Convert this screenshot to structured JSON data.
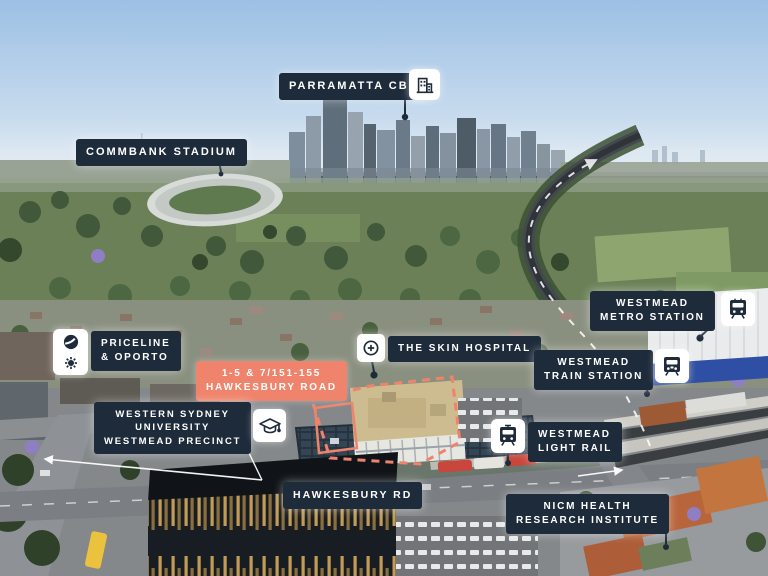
{
  "title": "Westmead aerial locality map",
  "colors": {
    "label_background": "#1e2b3b",
    "label_text": "#ffffff",
    "site_accent_coral": "#f0836b",
    "icon_tile_background": "#ffffff",
    "icon_glyph": "#1e2b3b"
  },
  "labels": {
    "parramatta_cbd": {
      "text": "PARRAMATTA CBD",
      "icon": "city-buildings-icon"
    },
    "commbank_stadium": {
      "text": "COMMBANK STADIUM"
    },
    "westmead_metro_station": {
      "lines": [
        "WESTMEAD",
        "METRO STATION"
      ],
      "icon": "metro-train-icon"
    },
    "priceline_oporto": {
      "lines": [
        "PRICELINE",
        "& OPORTO"
      ],
      "icons": [
        "priceline-logo-icon",
        "oporto-sun-icon"
      ]
    },
    "skin_hospital": {
      "text": "THE SKIN HOSPITAL",
      "icon": "medical-cross-icon"
    },
    "westmead_train_station": {
      "lines": [
        "WESTMEAD",
        "TRAIN STATION"
      ],
      "icon": "train-icon"
    },
    "property_address": {
      "lines": [
        "1-5 & 7/151-155",
        "HAWKESBURY ROAD"
      ]
    },
    "wsu_precinct": {
      "lines": [
        "WESTERN SYDNEY",
        "UNIVERSITY",
        "WESTMEAD PRECINCT"
      ],
      "icon": "graduation-cap-icon"
    },
    "westmead_light_rail": {
      "lines": [
        "WESTMEAD",
        "LIGHT RAIL"
      ],
      "icon": "tram-icon"
    },
    "hawkesbury_rd": {
      "text": "HAWKESBURY RD"
    },
    "nicm": {
      "lines": [
        "NICM HEALTH",
        "RESEARCH INSTITUTE"
      ]
    }
  }
}
